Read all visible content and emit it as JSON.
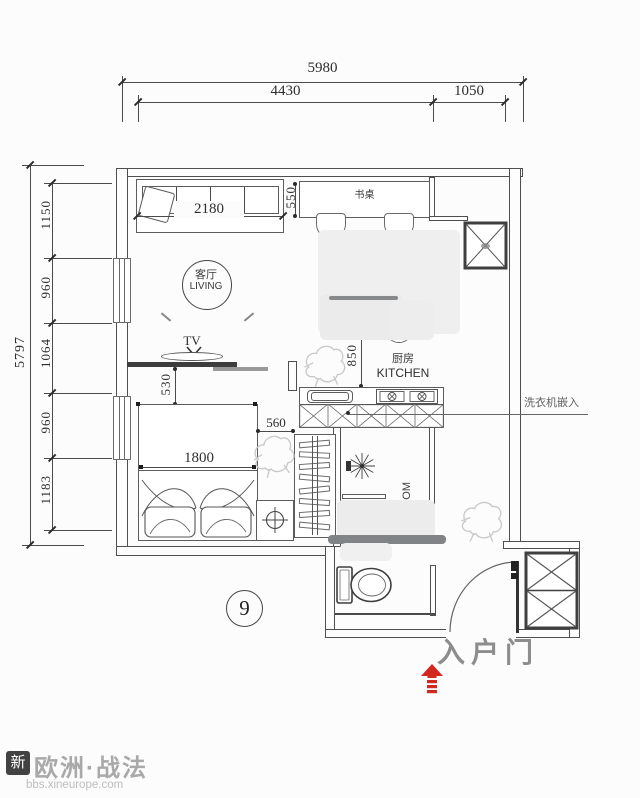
{
  "plan_number": "9",
  "dims": {
    "top": {
      "overall": "5980",
      "seg1": "4430",
      "seg2": "1050"
    },
    "left": {
      "overall": "5797",
      "seg1": "1150",
      "seg2": "960",
      "seg3": "1064",
      "seg4": "960",
      "seg5": "1183"
    },
    "sofa_width": "2180",
    "desk_depth": "550",
    "tv_offset": "530",
    "kitchen_clearance": "850",
    "bedside_width": "560",
    "bed_width": "1800"
  },
  "rooms": {
    "living_cn": "客厅",
    "living_en": "LIVING",
    "kitchen_cn": "厨房",
    "kitchen_en": "KITCHEN",
    "bathroom_fragment": "OM"
  },
  "labels": {
    "tv": "TV",
    "desk": "书桌",
    "washer_note": "洗衣机嵌入",
    "entry_door": "入户门"
  },
  "watermark": {
    "logo": "新",
    "brand": "欧洲·战法",
    "url": "bbs.xineurope.com"
  },
  "colors": {
    "plan_line": "#4a4a4a",
    "dim_text": "#2e2e2e",
    "entry_label_gray": "#8d8d8d",
    "accent_red": "#d3281e",
    "watermark_gray": "#a9a9a9"
  }
}
